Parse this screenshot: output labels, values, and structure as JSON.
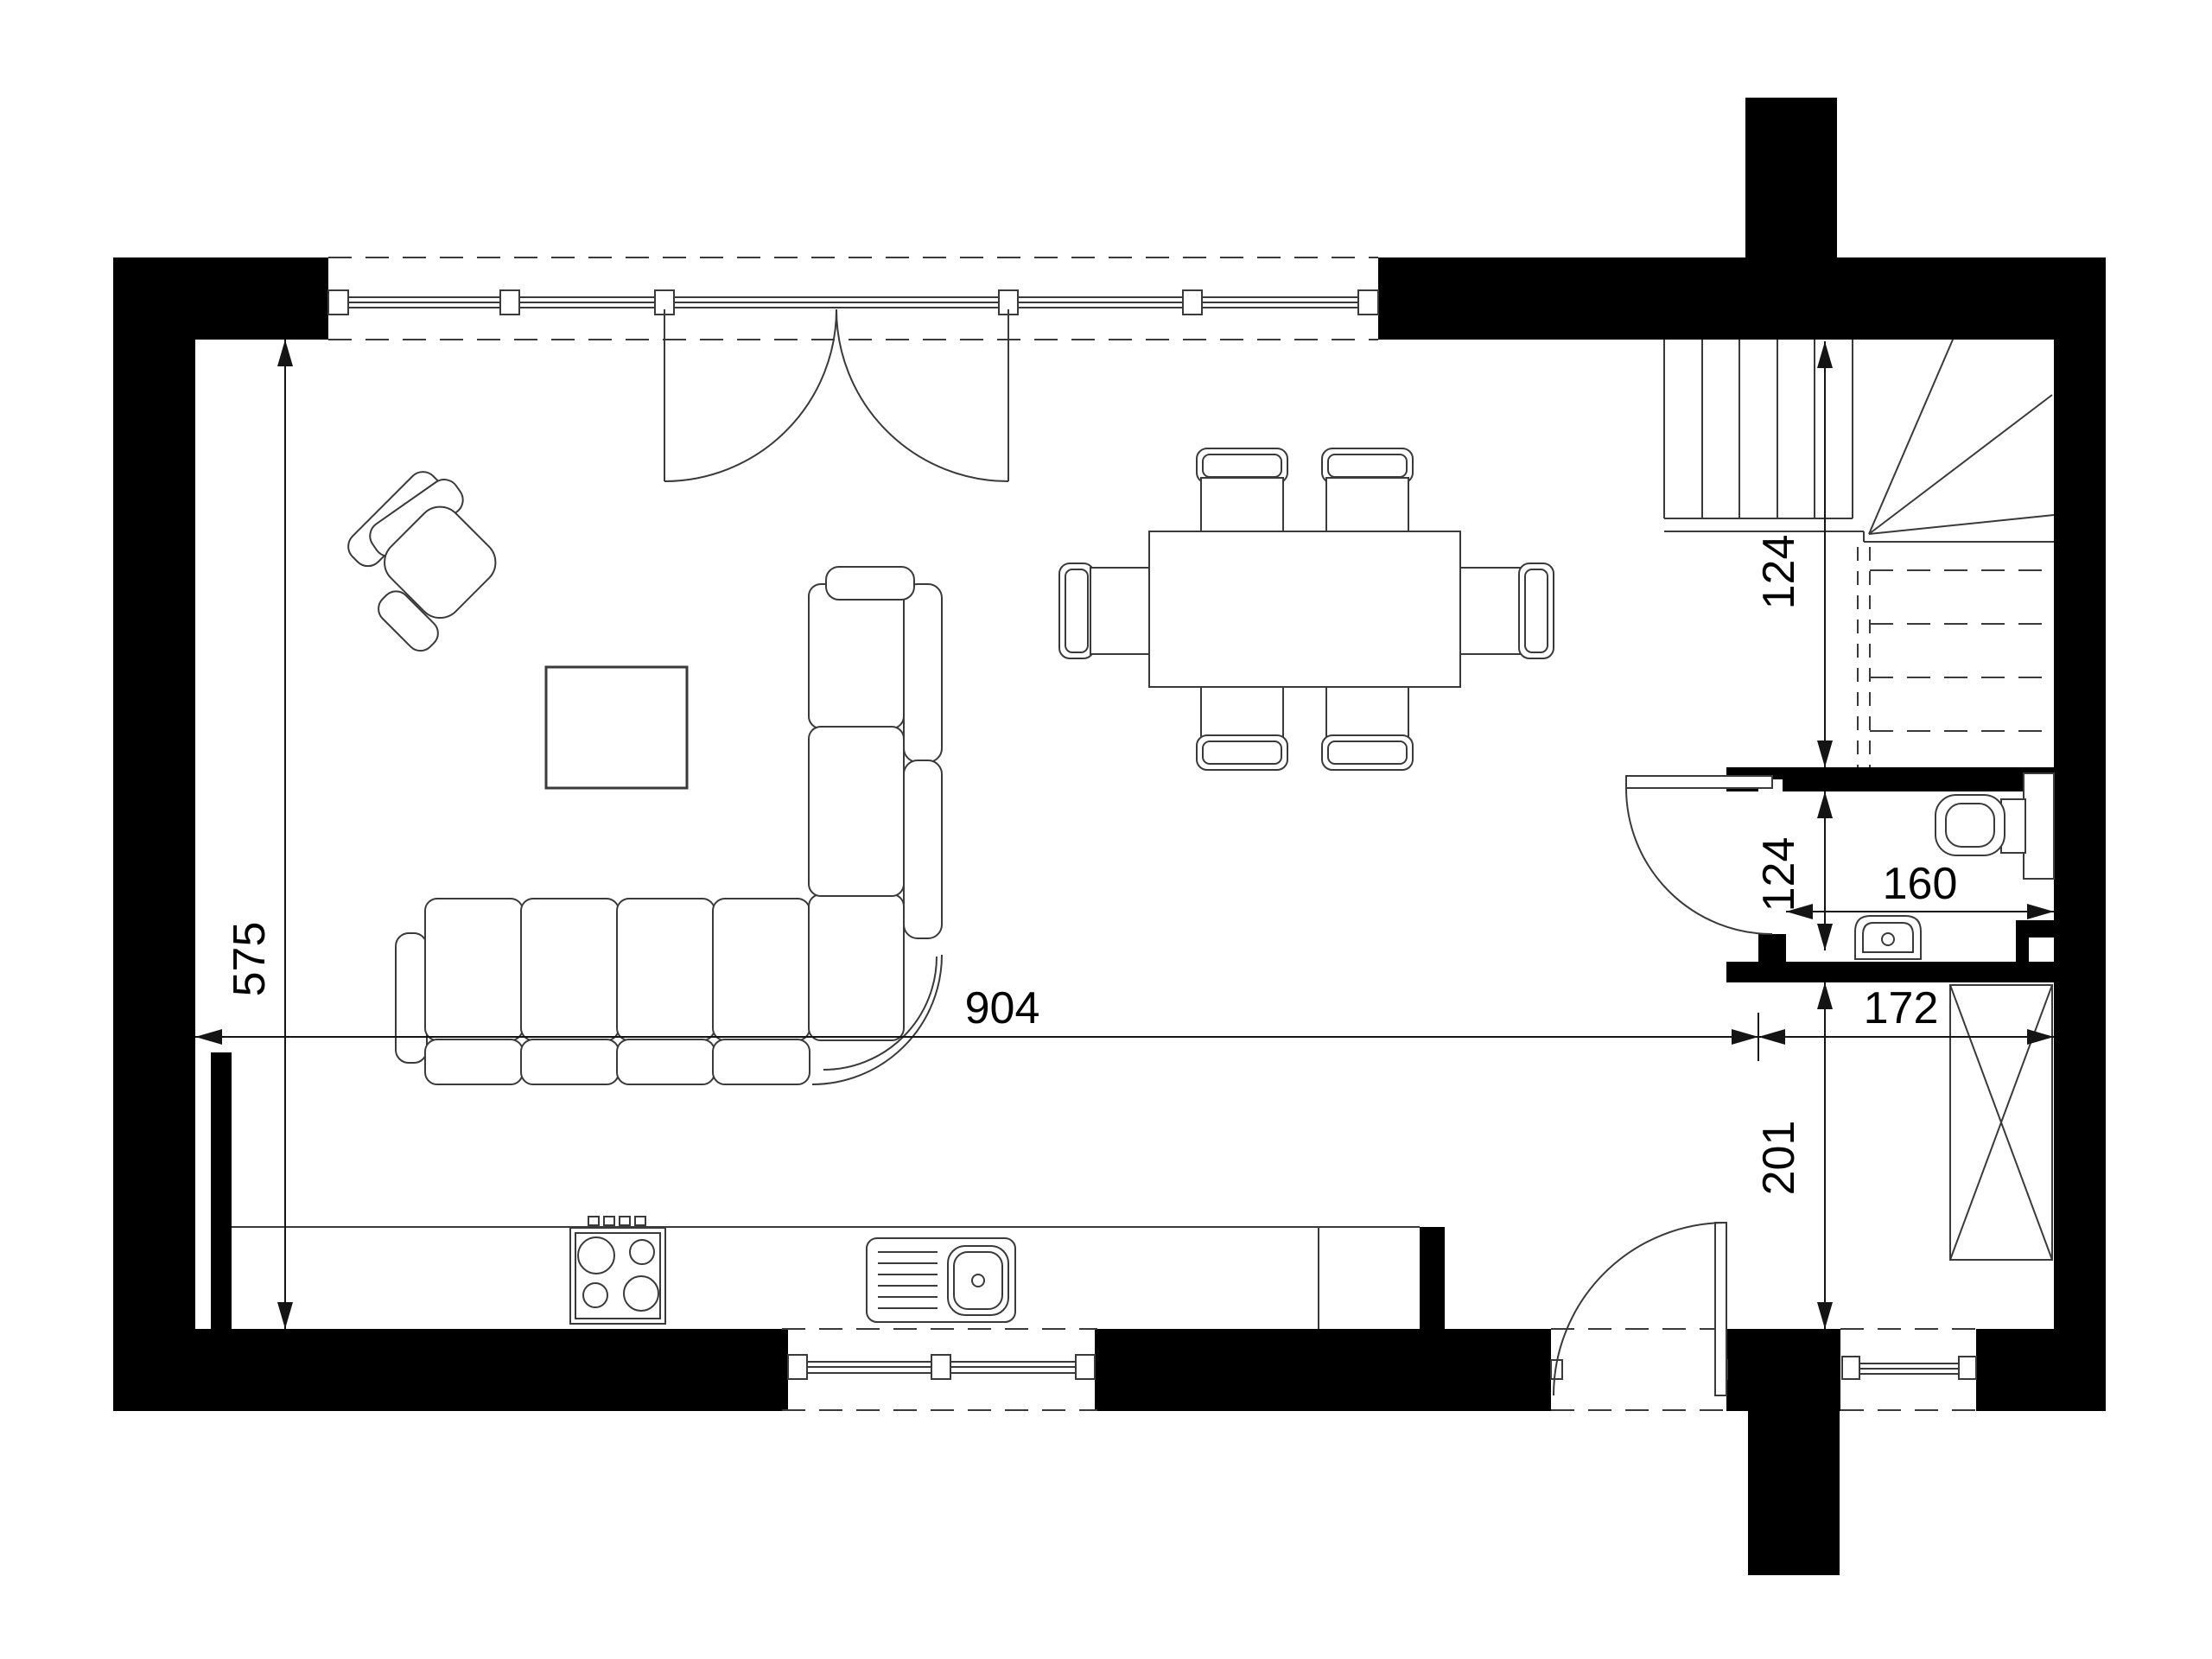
{
  "document": {
    "type": "architectural-floor-plan",
    "view": "top-down ground floor plan",
    "style": "black and white CAD drawing"
  },
  "colors": {
    "background": "#ffffff",
    "walls": "#000000",
    "drawing_lines": "#3a3a3a",
    "dimension_lines": "#141414"
  },
  "dimensions": {
    "living_height": {
      "value": "575",
      "orientation": "vertical",
      "location": "left side of living room"
    },
    "living_width": {
      "value": "904",
      "orientation": "horizontal",
      "location": "across living room"
    },
    "stair_opening": {
      "value": "124",
      "orientation": "vertical",
      "location": "stair landing to bathroom wall"
    },
    "bathroom_depth": {
      "value": "124",
      "orientation": "vertical",
      "location": "inside bathroom"
    },
    "bathroom_width": {
      "value": "160",
      "orientation": "horizontal",
      "location": "inside bathroom"
    },
    "hall_width": {
      "value": "172",
      "orientation": "horizontal",
      "location": "entry hall"
    },
    "hall_depth": {
      "value": "201",
      "orientation": "vertical",
      "location": "entry hall"
    }
  },
  "rooms": {
    "living_dining": "open living / dining room with kitchen run",
    "bathroom": "WC with toilet and basin",
    "hall": "entry hall with wardrobe",
    "stairs": "winder staircase to upper floor"
  },
  "furniture": [
    "armchair",
    "coffee-table",
    "corner-sofa",
    "dining-table",
    "dining-chairs-x6",
    "kitchen-counter",
    "stove-4-burners",
    "kitchen-sink",
    "toilet",
    "basin",
    "wardrobe"
  ]
}
